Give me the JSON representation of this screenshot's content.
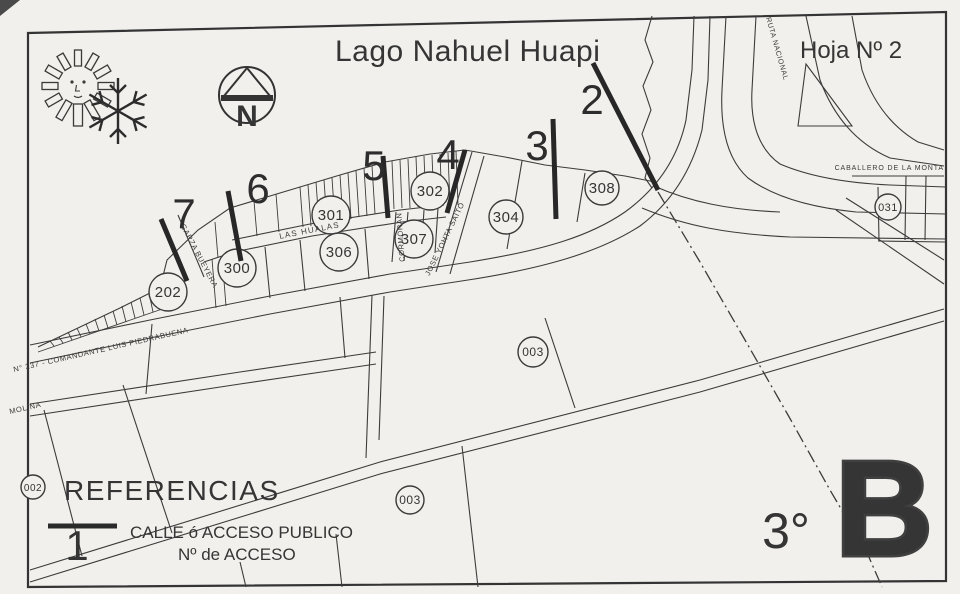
{
  "colors": {
    "paper": "#f1f0ec",
    "ink": "#343434",
    "heavy": "#404040"
  },
  "header": {
    "title": "Lago Nahuel Huapi",
    "sheet": "Hoja Nº 2"
  },
  "compass": {
    "letter": "N"
  },
  "corner": {
    "degree": "3°",
    "letter": "B"
  },
  "legend": {
    "title": "REFERENCIAS",
    "sample_access_number": "1",
    "line_label": "CALLE ó ACCESO PUBLICO",
    "number_label": "Nº de ACCESO"
  },
  "accesses": {
    "a2": "2",
    "a3": "3",
    "a4": "4",
    "a5": "5",
    "a6": "6",
    "a7": "7"
  },
  "parcels": {
    "p202": "202",
    "p300": "300",
    "p301": "301",
    "p302": "302",
    "p306": "306",
    "p307": "307",
    "p304": "304",
    "p308": "308",
    "p031": "031",
    "p003a": "003",
    "p003b": "003",
    "p002": "002"
  },
  "streets": {
    "garza": "GARZA BUEYERA",
    "hualas": "LAS HUALAS",
    "cormoran": "CORMORAN",
    "yohta": "JOSE YOHTA SAITO",
    "rn237": "N° 237 - COMANDANTE LUIS PIEDRABUENA",
    "molina": "MOLINA",
    "ruta": "RUTA NACIONAL",
    "caballero": "CABALLERO DE LA MONTA"
  }
}
